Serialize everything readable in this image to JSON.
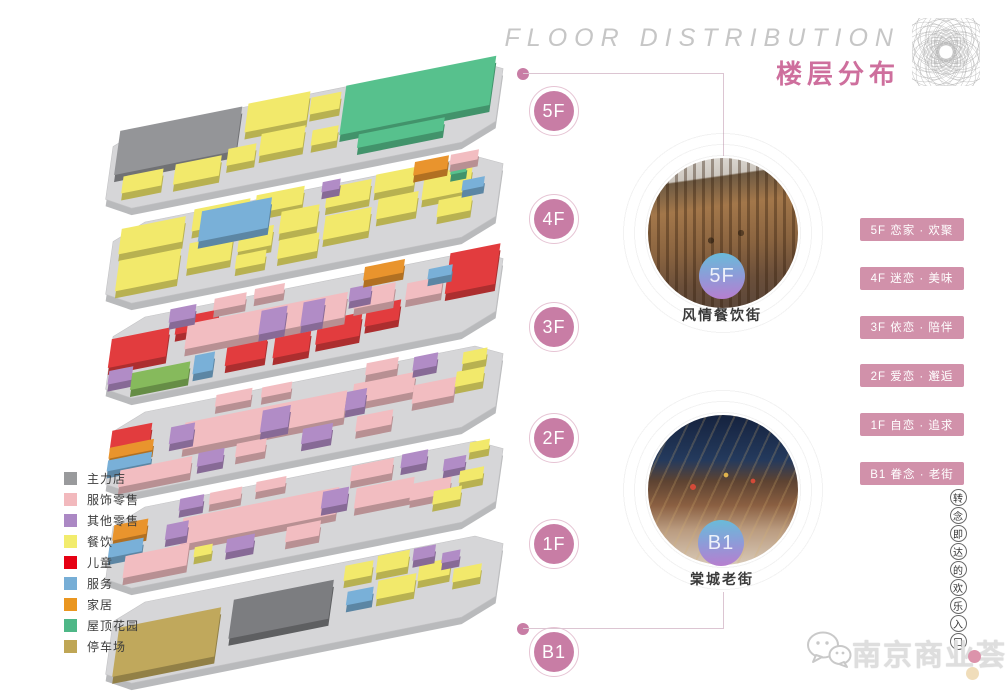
{
  "header": {
    "title_en": "FLOOR DISTRIBUTION",
    "title_zh": "楼层分布"
  },
  "accent": {
    "pink_circle": "#c87da5",
    "tag_background": "#d191aa",
    "title_pink": "#ce6f9d",
    "connector_line": "#dcc5d2"
  },
  "floors": [
    "5F",
    "4F",
    "3F",
    "2F",
    "1F",
    "B1"
  ],
  "features": [
    {
      "floor": "5F",
      "name": "风情餐饮街"
    },
    {
      "floor": "B1",
      "name": "棠城老街"
    }
  ],
  "floor_tags": [
    "5F 恋家 · 欢聚",
    "4F 迷恋 · 美味",
    "3F 依恋 · 陪伴",
    "2F 爱恋 · 邂逅",
    "1F 自恋 · 追求",
    "B1 眷念 · 老街"
  ],
  "legend": [
    {
      "label": "主力店",
      "color": "#999a9c"
    },
    {
      "label": "服饰零售",
      "color": "#f2b9bd"
    },
    {
      "label": "其他零售",
      "color": "#ab88c4"
    },
    {
      "label": "餐饮",
      "color": "#f2ec6d"
    },
    {
      "label": "儿童",
      "color": "#e60013"
    },
    {
      "label": "服务",
      "color": "#77aed6"
    },
    {
      "label": "家居",
      "color": "#ea9620"
    },
    {
      "label": "屋顶花园",
      "color": "#4eb787"
    },
    {
      "label": "停车场",
      "color": "#bfa655"
    }
  ],
  "watermark": {
    "name": "南京商业荟",
    "slogan": "转念即达的欢乐入口"
  },
  "stack": {
    "palette": {
      "gy": "#949598",
      "dg": "#7c7d80",
      "pk": "#f2bdc1",
      "pu": "#b18cc6",
      "ye": "#f2e96b",
      "rd": "#e23c3e",
      "bl": "#79b0d8",
      "or": "#e9942d",
      "gn": "#57c18d",
      "g2": "#86ba5c",
      "kh": "#c0a85c",
      "slab_top": "#d6d6d8",
      "slab_side": "#b9babc"
    },
    "floors": [
      {
        "id": "5F",
        "blocks": [
          [
            "gy",
            6,
            6,
            122,
            52
          ],
          [
            "ye",
            134,
            4,
            62,
            34
          ],
          [
            "ye",
            198,
            12,
            30,
            20
          ],
          [
            "ye",
            152,
            44,
            44,
            26
          ],
          [
            "ye",
            120,
            54,
            28,
            20
          ],
          [
            "ye",
            68,
            60,
            46,
            24
          ],
          [
            "ye",
            16,
            62,
            40,
            20
          ],
          [
            "ye",
            204,
            52,
            26,
            18
          ],
          [
            "gn",
            232,
            6,
            150,
            58
          ],
          [
            "gn",
            252,
            68,
            86,
            16
          ]
        ]
      },
      {
        "id": "4F",
        "blocks": [
          [
            "ye",
            8,
            10,
            64,
            30
          ],
          [
            "ye",
            80,
            4,
            56,
            26
          ],
          [
            "ye",
            142,
            2,
            48,
            22
          ],
          [
            "ye",
            10,
            48,
            62,
            36
          ],
          [
            "ye",
            80,
            44,
            44,
            30
          ],
          [
            "ye",
            130,
            42,
            34,
            24
          ],
          [
            "ye",
            170,
            28,
            38,
            26
          ],
          [
            "ye",
            214,
            10,
            44,
            24
          ],
          [
            "ye",
            262,
            6,
            40,
            22
          ],
          [
            "ye",
            216,
            44,
            46,
            28
          ],
          [
            "ye",
            268,
            36,
            40,
            24
          ],
          [
            "ye",
            312,
            18,
            48,
            30
          ],
          [
            "ye",
            330,
            52,
            34,
            20
          ],
          [
            "ye",
            172,
            62,
            40,
            22
          ],
          [
            "ye",
            130,
            70,
            30,
            16
          ],
          [
            "bl",
            88,
            8,
            70,
            36
          ],
          [
            "pu",
            208,
            2,
            18,
            12
          ],
          [
            "or",
            300,
            0,
            34,
            16
          ],
          [
            "gn",
            338,
            14,
            16,
            10
          ],
          [
            "bl",
            352,
            34,
            22,
            12
          ],
          [
            "pk",
            336,
            0,
            28,
            12
          ]
        ]
      },
      {
        "id": "3F",
        "blocks": [
          [
            "rd",
            0,
            26,
            58,
            34
          ],
          [
            "rd",
            336,
            4,
            50,
            48
          ],
          [
            "rd",
            120,
            58,
            40,
            28
          ],
          [
            "rd",
            168,
            62,
            36,
            26
          ],
          [
            "rd",
            210,
            54,
            44,
            28
          ],
          [
            "rd",
            258,
            48,
            34,
            24
          ],
          [
            "rd",
            64,
            16,
            42,
            20
          ],
          [
            "pk",
            76,
            26,
            160,
            30
          ],
          [
            "pk",
            100,
            2,
            32,
            14
          ],
          [
            "pk",
            140,
            0,
            30,
            12
          ],
          [
            "pk",
            244,
            26,
            40,
            22
          ],
          [
            "pk",
            296,
            30,
            36,
            20
          ],
          [
            "pu",
            56,
            4,
            26,
            16
          ],
          [
            "pu",
            150,
            28,
            26,
            28
          ],
          [
            "pu",
            192,
            28,
            22,
            28
          ],
          [
            "pu",
            2,
            64,
            24,
            16
          ],
          [
            "pu",
            238,
            22,
            22,
            16
          ],
          [
            "g2",
            26,
            72,
            58,
            20
          ],
          [
            "bl",
            88,
            66,
            20,
            22
          ],
          [
            "or",
            250,
            0,
            40,
            16
          ],
          [
            "bl",
            316,
            18,
            24,
            12
          ]
        ]
      },
      {
        "id": "2F",
        "blocks": [
          [
            "rd",
            0,
            22,
            40,
            24
          ],
          [
            "or",
            0,
            42,
            44,
            13
          ],
          [
            "bl",
            0,
            57,
            44,
            13
          ],
          [
            "pk",
            14,
            72,
            72,
            20
          ],
          [
            "pk",
            74,
            30,
            162,
            32
          ],
          [
            "pk",
            242,
            24,
            62,
            24
          ],
          [
            "pk",
            102,
            4,
            36,
            14
          ],
          [
            "pk",
            148,
            6,
            30,
            12
          ],
          [
            "pk",
            252,
            2,
            32,
            14
          ],
          [
            "pk",
            304,
            40,
            42,
            22
          ],
          [
            "pk",
            250,
            64,
            36,
            18
          ],
          [
            "pk",
            130,
            68,
            30,
            16
          ],
          [
            "pu",
            60,
            32,
            24,
            20
          ],
          [
            "pu",
            152,
            34,
            28,
            26
          ],
          [
            "pu",
            196,
            66,
            30,
            18
          ],
          [
            "pu",
            92,
            70,
            26,
            16
          ],
          [
            "pu",
            300,
            6,
            24,
            16
          ],
          [
            "pu",
            236,
            32,
            20,
            22
          ],
          [
            "ye",
            346,
            34,
            28,
            18
          ],
          [
            "ye",
            350,
            12,
            24,
            14
          ]
        ]
      },
      {
        "id": "1F",
        "blocks": [
          [
            "or",
            2,
            22,
            34,
            18
          ],
          [
            "bl",
            0,
            44,
            34,
            16
          ],
          [
            "pk",
            72,
            30,
            156,
            32
          ],
          [
            "pk",
            18,
            62,
            64,
            26
          ],
          [
            "pk",
            96,
            6,
            32,
            14
          ],
          [
            "pk",
            142,
            4,
            30,
            12
          ],
          [
            "pk",
            238,
            8,
            42,
            18
          ],
          [
            "pk",
            246,
            36,
            58,
            24
          ],
          [
            "pk",
            302,
            44,
            40,
            20
          ],
          [
            "pk",
            180,
            66,
            34,
            18
          ],
          [
            "pu",
            56,
            34,
            22,
            18
          ],
          [
            "pu",
            120,
            66,
            28,
            16
          ],
          [
            "pu",
            212,
            32,
            26,
            20
          ],
          [
            "pu",
            288,
            6,
            26,
            16
          ],
          [
            "pu",
            332,
            22,
            22,
            14
          ],
          [
            "pu",
            66,
            6,
            24,
            14
          ],
          [
            "ye",
            88,
            68,
            18,
            12
          ],
          [
            "ye",
            350,
            40,
            24,
            14
          ],
          [
            "ye",
            326,
            58,
            28,
            16
          ],
          [
            "ye",
            356,
            8,
            20,
            12
          ]
        ]
      },
      {
        "id": "B1",
        "blocks": [
          [
            "kh",
            8,
            32,
            102,
            58
          ],
          [
            "dg",
            122,
            26,
            100,
            46
          ],
          [
            "ye",
            232,
            12,
            28,
            18
          ],
          [
            "ye",
            264,
            8,
            32,
            20
          ],
          [
            "ye",
            268,
            38,
            38,
            22
          ],
          [
            "ye",
            308,
            28,
            32,
            20
          ],
          [
            "ye",
            344,
            42,
            28,
            16
          ],
          [
            "pu",
            300,
            8,
            22,
            14
          ],
          [
            "pu",
            330,
            20,
            18,
            12
          ],
          [
            "bl",
            238,
            44,
            26,
            16
          ]
        ]
      }
    ]
  }
}
